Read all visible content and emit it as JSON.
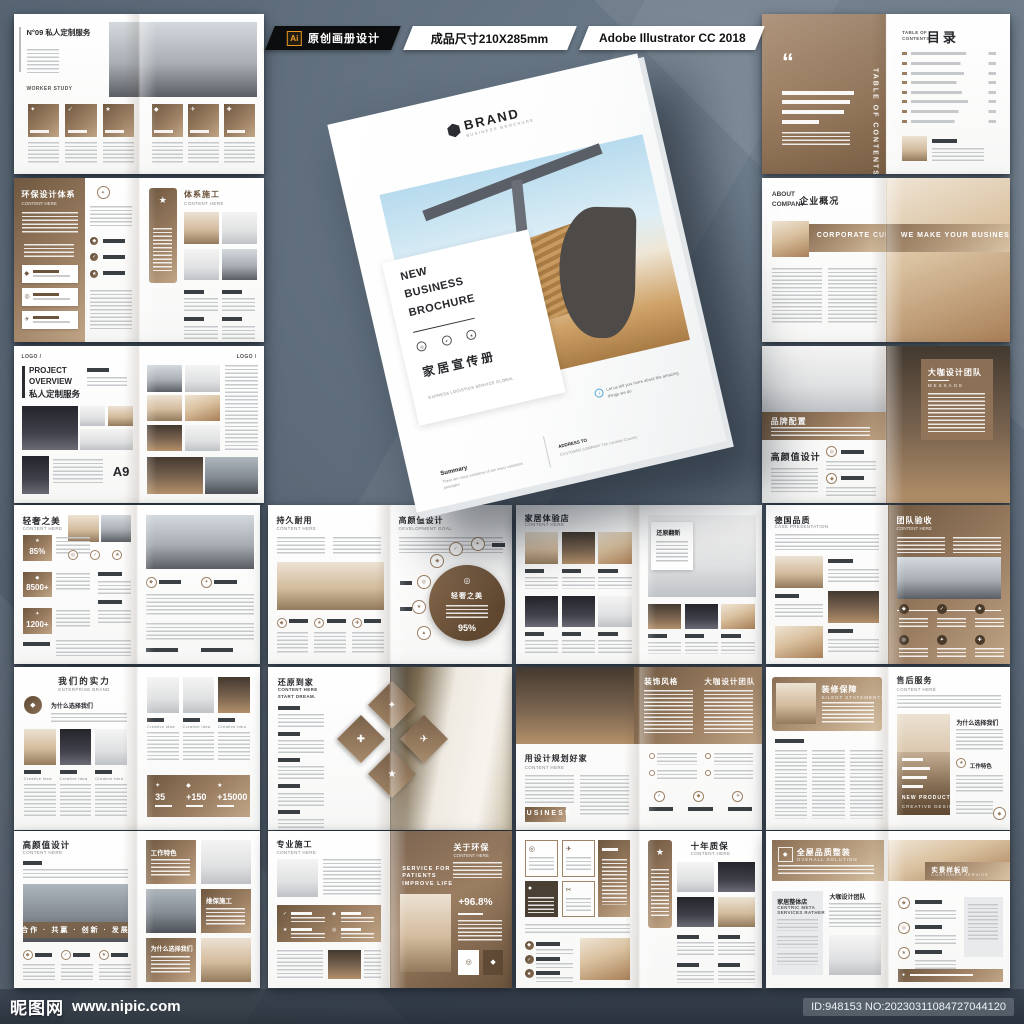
{
  "topbar": {
    "ai_badge": "Ai",
    "tag_design": "原创画册设计",
    "tag_size": "成品尺寸210X285mm",
    "tag_software": "Adobe Illustrator CC 2018"
  },
  "watermark": {
    "site_name": "昵图网",
    "site_url": "www.nipic.com",
    "image_id": "ID:948153 NO:20230311084727044120"
  },
  "colors": {
    "accent": "#9b7e62",
    "accent_dark": "#6b533c",
    "accent_light": "#c9ae8d",
    "background": "#5b6877",
    "blue": "#57a8d8"
  },
  "icons": {
    "check": "✓",
    "star": "★",
    "plane": "✈",
    "scissors": "✂",
    "target": "◎",
    "gem": "◆",
    "spark": "✦",
    "plus": "✚",
    "quote": "“",
    "dot": "●",
    "ring": "○",
    "tri": "▲",
    "info": "i"
  },
  "cover": {
    "brand": "BRAND",
    "brand_sub": "BUSINESS BROCHURE",
    "title_1": "NEW",
    "title_2": "BUSINESS",
    "title_3": "BROCHURE",
    "title_cn": "家居宣传册",
    "subtitle_en": "EXPRESS LOGISTICS SERVICE GLOBAL",
    "summary_label": "Summary",
    "summary_text": "There are many variations of are many variations passages",
    "address_label": "ADDRESS TO",
    "address_text": "CUSTOMER COMPANY The Location Country",
    "note_text": "Let us tell you more about the amazing things we do"
  },
  "spreads": {
    "r1l": {
      "no": "N°09",
      "title": "私人定制服务",
      "sub": "WORKER  STUDY"
    },
    "r1r": {
      "toc1": "TABLE OF",
      "toc2": "CONTENTS",
      "cn": "目录",
      "side": "TABLE OF CONTENTS"
    },
    "r2l": {
      "lt": "环保设计体系",
      "ls": "CONTENT HERE",
      "rt": "体系施工",
      "rs": "CONTENT HERE"
    },
    "r2r": {
      "en1": "ABOUT",
      "en2": "COMPANY",
      "cn": "企业概况",
      "band1": "CORPORATE CULTURE",
      "band2": "WE MAKE YOUR BUSINESS!"
    },
    "r3l": {
      "logo": "LOGO /",
      "en1": "PROJECT",
      "en2": "OVERVIEW",
      "cn": "私人定制服务",
      "pg": "A9"
    },
    "r3r": {
      "band": "品牌配置",
      "title": "高颜值设计",
      "panel": "大咖设计团队",
      "msg": "MESSAGE"
    },
    "r4a": {
      "t": "轻奢之美",
      "s": "CONTENT HERE",
      "v1": "85%",
      "v2": "8500+",
      "v3": "1200+"
    },
    "r4b": {
      "lt": "持久耐用",
      "ls": "CONTENT HERE",
      "rt": "高颜值设计",
      "rs": "DEVELOPMENT GOAL",
      "c": "轻奢之美",
      "pct": "95%"
    },
    "r4c": {
      "t": "家居体验店",
      "s": "CONTENT HERE",
      "card": "还原翻新"
    },
    "r4d": {
      "lt": "德国品质",
      "ls": "CASE PRESENTATION",
      "rt": "团队验收",
      "rs": "CONTENT HERE"
    },
    "r5a": {
      "t": "我们的实力",
      "s": "ENTERPRISE BRAND",
      "why": "为什么选择我们",
      "cap": "Creative Idea",
      "v1": "35",
      "v2": "+150",
      "v3": "+15000"
    },
    "r5b": {
      "t": "还原到家",
      "s": "CONTENT HERE",
      "s2": "START DREAM."
    },
    "r5c": {
      "b1": "装饰风格",
      "b2": "大咖设计团队",
      "t": "用设计规划好家",
      "s": "CONTENT HERE",
      "biz": "BUSINESS"
    },
    "r5d": {
      "band": "装修保障",
      "bs": "SILENT STATEMENTS",
      "t": "售后服务",
      "s": "CONTENT HERE",
      "np1": "NEW PRODUCTS",
      "np2": "CREATIVE DESIGN",
      "why": "为什么选择我们",
      "feat": "工作特色"
    },
    "r6a": {
      "t": "高颜值设计",
      "s": "CONTENT HERE",
      "slogan": "合作 · 共赢 · 创新 · 发展",
      "b1": "工作特色",
      "b2": "维保施工",
      "b3": "为什么选择我们"
    },
    "r6b": {
      "lt": "专业施工",
      "ls": "CONTENT HERE",
      "rt": "关于环保",
      "rs": "CONTENT HERE",
      "svc1": "SERVICE FOR",
      "svc2": "PATIENTS",
      "svc3": "IMPROVE LIFE",
      "pct": "+96.8%"
    },
    "r6c": {
      "t": "十年质保",
      "s": "CONTENT HERE"
    },
    "r6d": {
      "t": "全屋品质整装",
      "s": "OVERALL SOLUTION",
      "lbl": "实景样板间",
      "lbls": "CUSTOMER SERVICE",
      "g1": "家居整体店",
      "g2": "CENTRIC META",
      "g3": "SERVICES RATHER",
      "team": "大咖设计团队"
    }
  }
}
